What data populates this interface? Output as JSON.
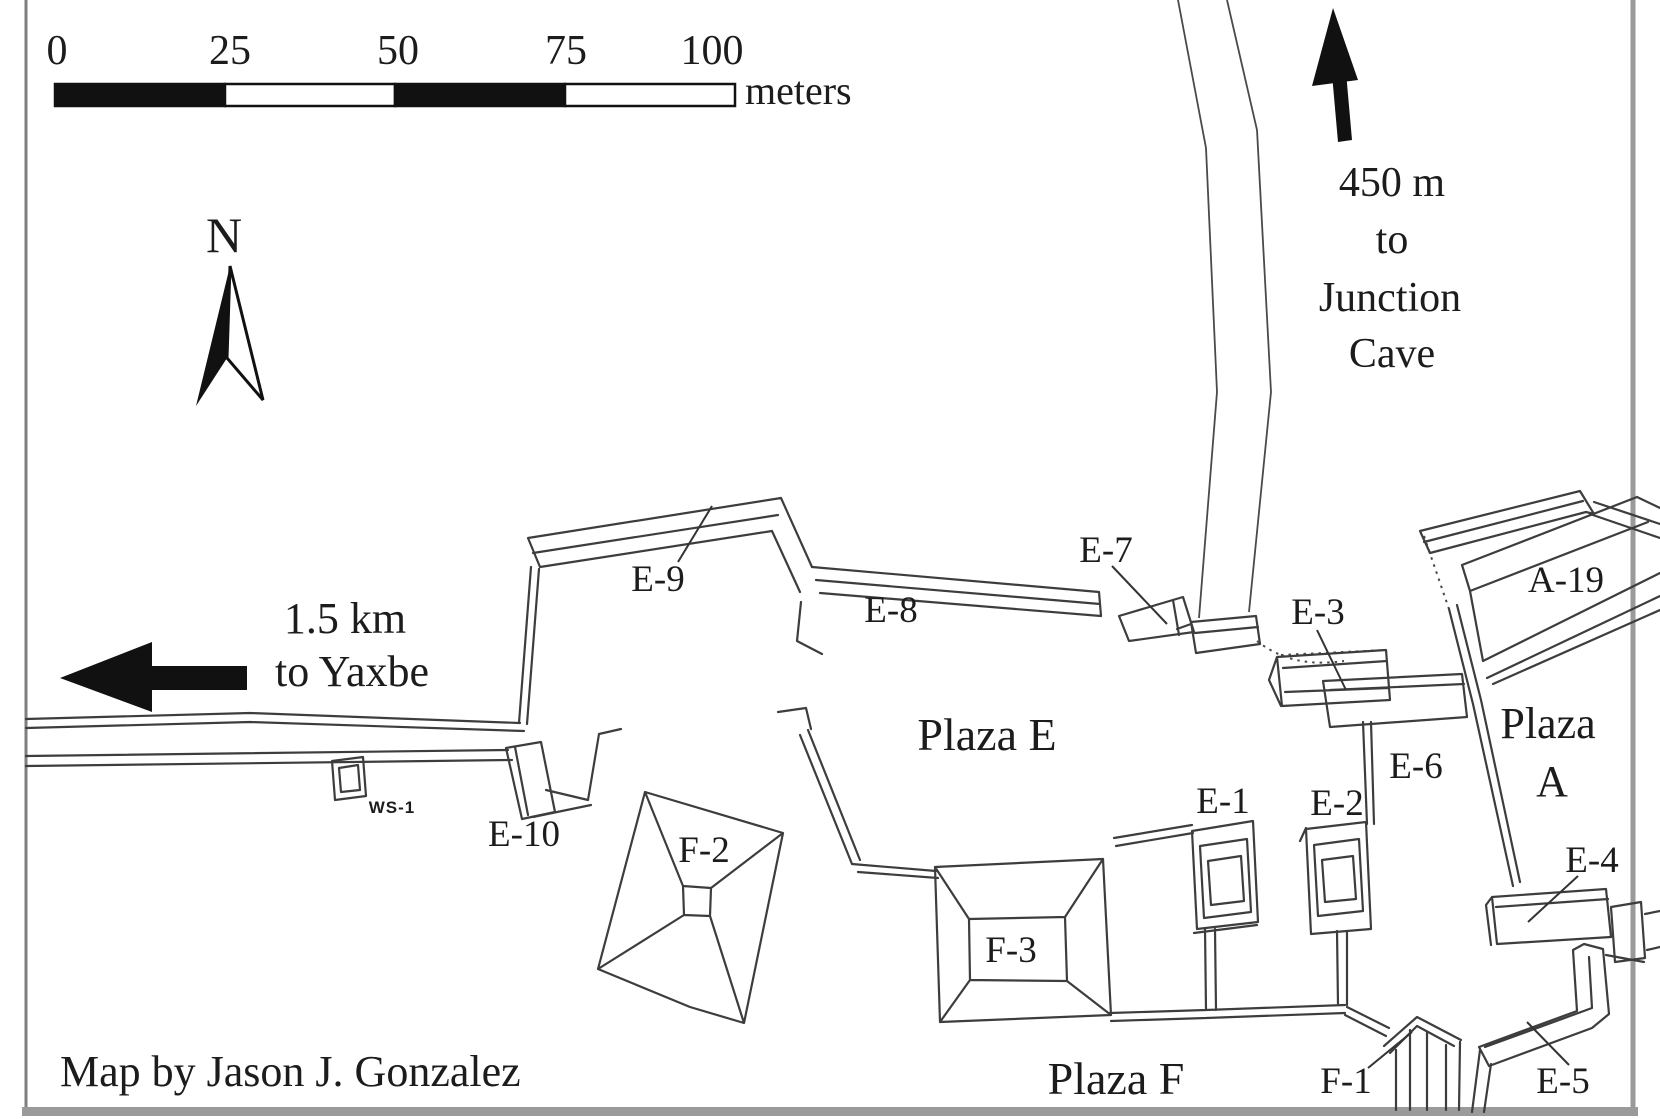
{
  "scale_bar": {
    "ticks": [
      "0",
      "25",
      "50",
      "75",
      "100"
    ],
    "unit": "meters"
  },
  "compass": {
    "label": "N"
  },
  "directions": {
    "yaxbe": {
      "line1": "1.5 km",
      "line2": "to Yaxbe"
    },
    "cave": {
      "line1": "450 m",
      "line2": "to",
      "line3": "Junction",
      "line4": "Cave"
    }
  },
  "plazas": {
    "e": "Plaza E",
    "a_line1": "Plaza",
    "a_line2": "A",
    "f": "Plaza F"
  },
  "structures": {
    "e1": "E-1",
    "e2": "E-2",
    "e3": "E-3",
    "e4": "E-4",
    "e5": "E-5",
    "e6": "E-6",
    "e7": "E-7",
    "e8": "E-8",
    "e9": "E-9",
    "e10": "E-10",
    "f1": "F-1",
    "f2": "F-2",
    "f3": "F-3",
    "a19": "A-19",
    "ws1": "WS-1"
  },
  "credit": "Map by Jason J. Gonzalez",
  "colors": {
    "ink": "#3d3d3d",
    "frame": "#9a9a9a",
    "background": "#ffffff"
  }
}
